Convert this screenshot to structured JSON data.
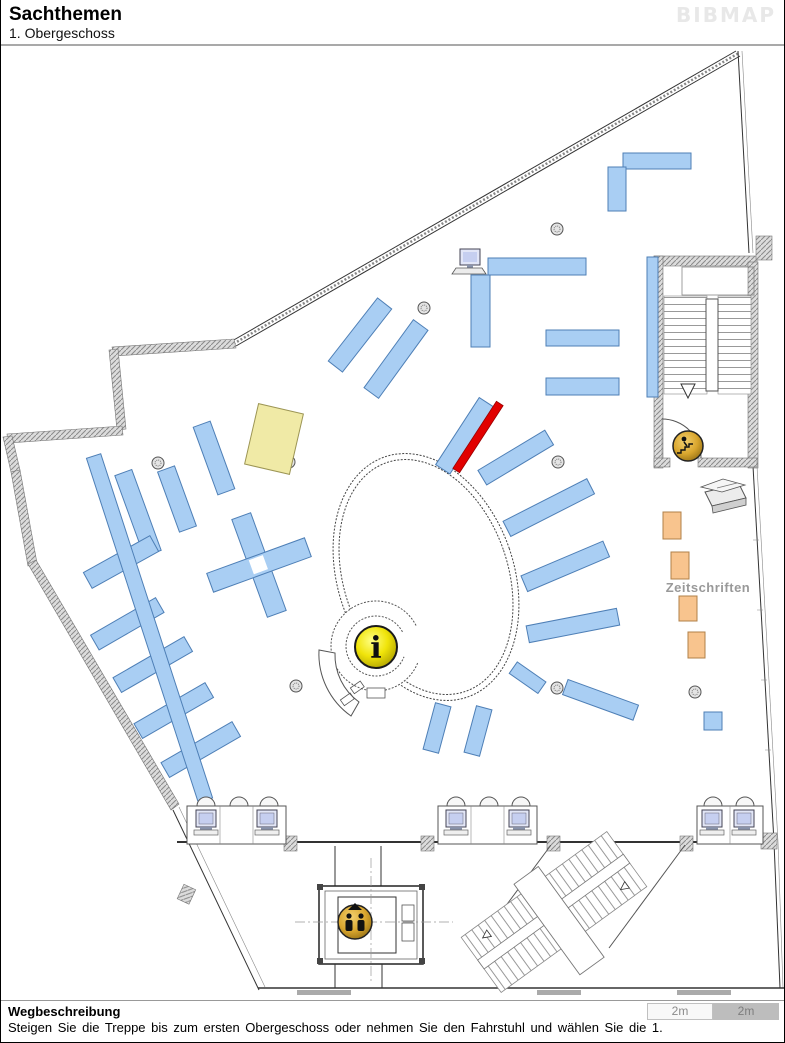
{
  "header": {
    "title": "Sachthemen",
    "subtitle": "1. Obergeschoss",
    "logo": "BIBMAP"
  },
  "map": {
    "zeitschriften_label": "Zeitschriften",
    "info_glyph": "i",
    "highlighted_subject_area": "Sachthemen",
    "floor": "1. Obergeschoss"
  },
  "footer": {
    "heading": "Wegbeschreibung",
    "directions": "Steigen Sie die Treppe bis zum ersten Obergeschoss oder nehmen Sie den Fahrstuhl und wählen Sie die 1.",
    "scale_left": "2m",
    "scale_right": "2m"
  },
  "colors": {
    "shelf_blue": "#A9CEF3",
    "shelf_blue_border": "#4E7FB6",
    "highlight_red": "#E10000",
    "highlight_red_border": "#990000",
    "orange": "#F8C48E",
    "orange_border": "#B08048",
    "yellow": "#F0EAA6",
    "yellow_border": "#9C9554",
    "info_yellow": "#F2E40A",
    "elevator_gold": "#D9A62E",
    "label_gray": "#999999",
    "scale_light": "#F8F8F8",
    "scale_dark": "#BDBDBD"
  }
}
